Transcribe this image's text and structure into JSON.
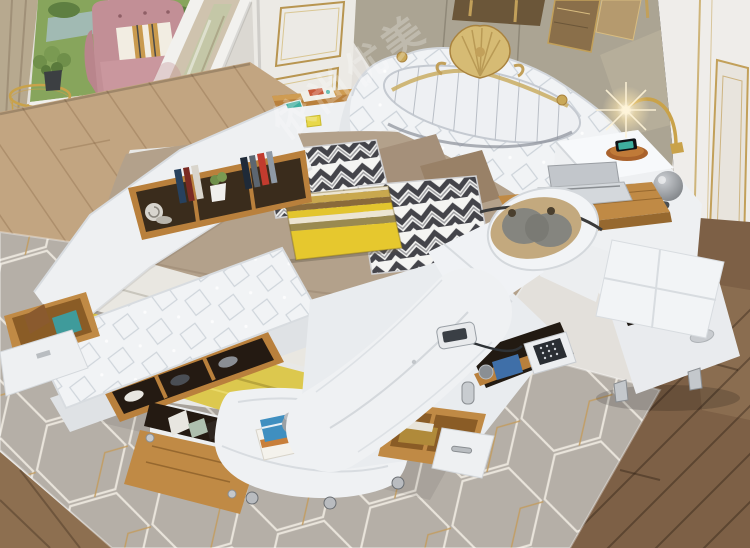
{
  "watermark": {
    "text": "依尚优美"
  },
  "palette": {
    "bed_leather": "#f1f3f5",
    "bedding_taupe": "#b3a18b",
    "blanket_yellow": "#dcc84e",
    "wood_oak": "#c08a45",
    "floor_dark": "#7d6046",
    "floor_light": "#c2a581",
    "rug_gray": "#b5afa7",
    "rug_line_white": "#e9e4db",
    "rug_line_gold": "#c29d61",
    "wall_white": "#efedea",
    "trim_gold": "#c2a05a",
    "fabric_panel": "#aba493",
    "armchair_pink": "#c28f96",
    "massage_pillow_gray": "#85857f",
    "massage_pillow_tan": "#c3a97e",
    "chevron_dark": "#44444a",
    "watermark_white": "#ffffff"
  },
  "scene": {
    "objects": [
      "multifunction-smart-bed",
      "tufted-headboard-gold-crest",
      "pleated-headboard-panel",
      "taupe-duvet",
      "white-sheet",
      "yellow-blanket",
      "chevron-pillow",
      "yellow-striped-pillow",
      "taupe-pillow",
      "storage-side-rail-bookshelf",
      "snail-ornament",
      "mini-potted-plant",
      "tufted-storage-bench",
      "shoe-rack",
      "open-side-drawer",
      "drop-down-storage-door",
      "foot-bench",
      "book-stack",
      "lidded-canister",
      "massage-chaise-lounge",
      "neck-massage-pillow",
      "headrest-ring",
      "wired-remote-control",
      "electronic-safe",
      "open-foot-drawer",
      "storage-niche-books",
      "media-side-unit",
      "speaker-grilles",
      "phone-on-wireless-tray",
      "pull-out-desk",
      "silver-laptop",
      "sphere-speaker",
      "gold-arc-lamp",
      "storage-ottoman-open",
      "brown-blanket",
      "geometric-area-rug",
      "hardwood-floor",
      "window-garden-view",
      "taupe-curtain",
      "sheer-curtain",
      "pink-armchair",
      "striped-accent-pillow",
      "gold-wire-side-table",
      "potted-plant",
      "leaning-floor-mirror",
      "paneled-door-gold-trim",
      "fabric-wall-panel",
      "bronze-wall-decor",
      "gold-trim-wall-frame",
      "warning-sticker",
      "bedside-shelf-magazines"
    ]
  }
}
